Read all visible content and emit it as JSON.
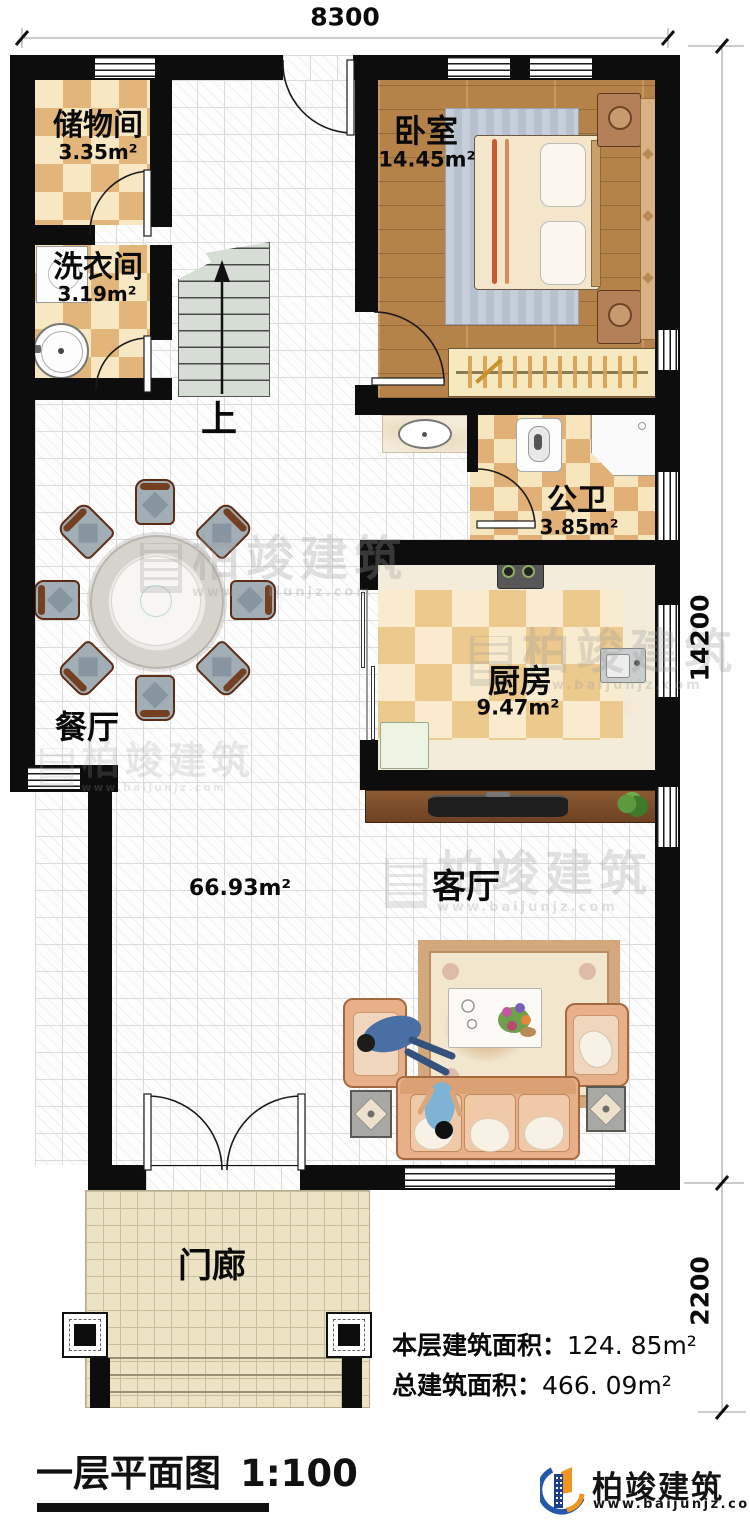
{
  "dimensions": {
    "top_width": "8300",
    "right_height_main": "14200",
    "right_height_porch": "2200"
  },
  "rooms": {
    "storage": {
      "name": "储物间",
      "area": "3.35m²"
    },
    "laundry": {
      "name": "洗衣间",
      "area": "3.19m²"
    },
    "bedroom": {
      "name": "卧室",
      "area": "14.45m²"
    },
    "bathroom": {
      "name": "公卫",
      "area": "3.85m²"
    },
    "kitchen": {
      "name": "厨房",
      "area": "9.47m²"
    },
    "dining": {
      "name": "餐厅"
    },
    "living": {
      "name": "客厅",
      "area": "66.93m²"
    },
    "porch": {
      "name": "门廊"
    },
    "stairs": {
      "up": "上"
    }
  },
  "summary": {
    "floor_label": "本层建筑面积：",
    "floor_value": "124. 85m²",
    "total_label": "总建筑面积：",
    "total_value": "466. 09m²"
  },
  "title_block": {
    "title": "一层平面图",
    "scale": "1:100"
  },
  "brand": {
    "name": "柏竣建筑",
    "website": "www.baijunjz.com"
  },
  "colors": {
    "wall": "#0d0d0d",
    "checker_dark": "#e2b57b",
    "checker_light": "#f7e7c3",
    "wood_floor": "#b5834a",
    "porch_tile": "#ebe3c3",
    "stair": "#d6ddd4",
    "sofa": "#e8b089",
    "logo_blue": "#2458a8",
    "logo_orange": "#f0941d",
    "watermark": "#9c9c9c"
  }
}
